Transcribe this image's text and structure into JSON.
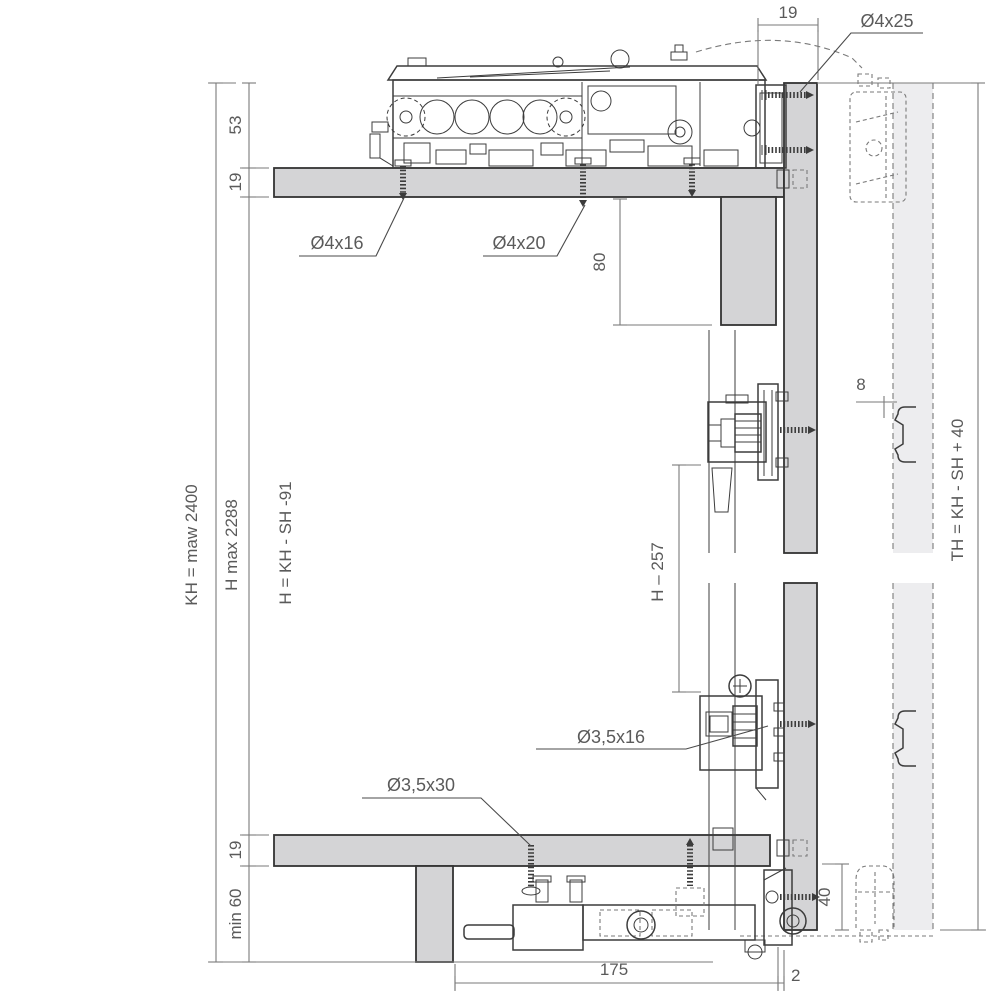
{
  "drawing_title": "sliding-door fitting installation cross-section",
  "colors": {
    "panel": "#d4d4d6",
    "ghost": "#ededef",
    "line": "#3c3c3c",
    "dim": "#7a7a7a",
    "text": "#5a5a5a",
    "background": "#ffffff"
  },
  "labels": {
    "top_gap": "19",
    "screw_top": "Ø4x25",
    "track_height": "53",
    "shelf_thickness": "19",
    "cabinet_height": "KH = maw 2400",
    "height_max": "H max 2288",
    "door_height_formula": "H = KH - SH -91",
    "screw_front_left": "Ø4x16",
    "screw_front_mid": "Ø4x20",
    "clearance_depth": "80",
    "clip_offset": "8",
    "bracket_spacing": "H – 257",
    "screw_bracket": "Ø3,5x16",
    "screw_bottom": "Ø3,5x30",
    "bottom_panel_thickness": "19",
    "plinth_min_height": "min 60",
    "guide_height": "40",
    "guide_depth": "175",
    "door_gap": "2",
    "partition_height_formula": "TH = KH - SH + 40"
  }
}
